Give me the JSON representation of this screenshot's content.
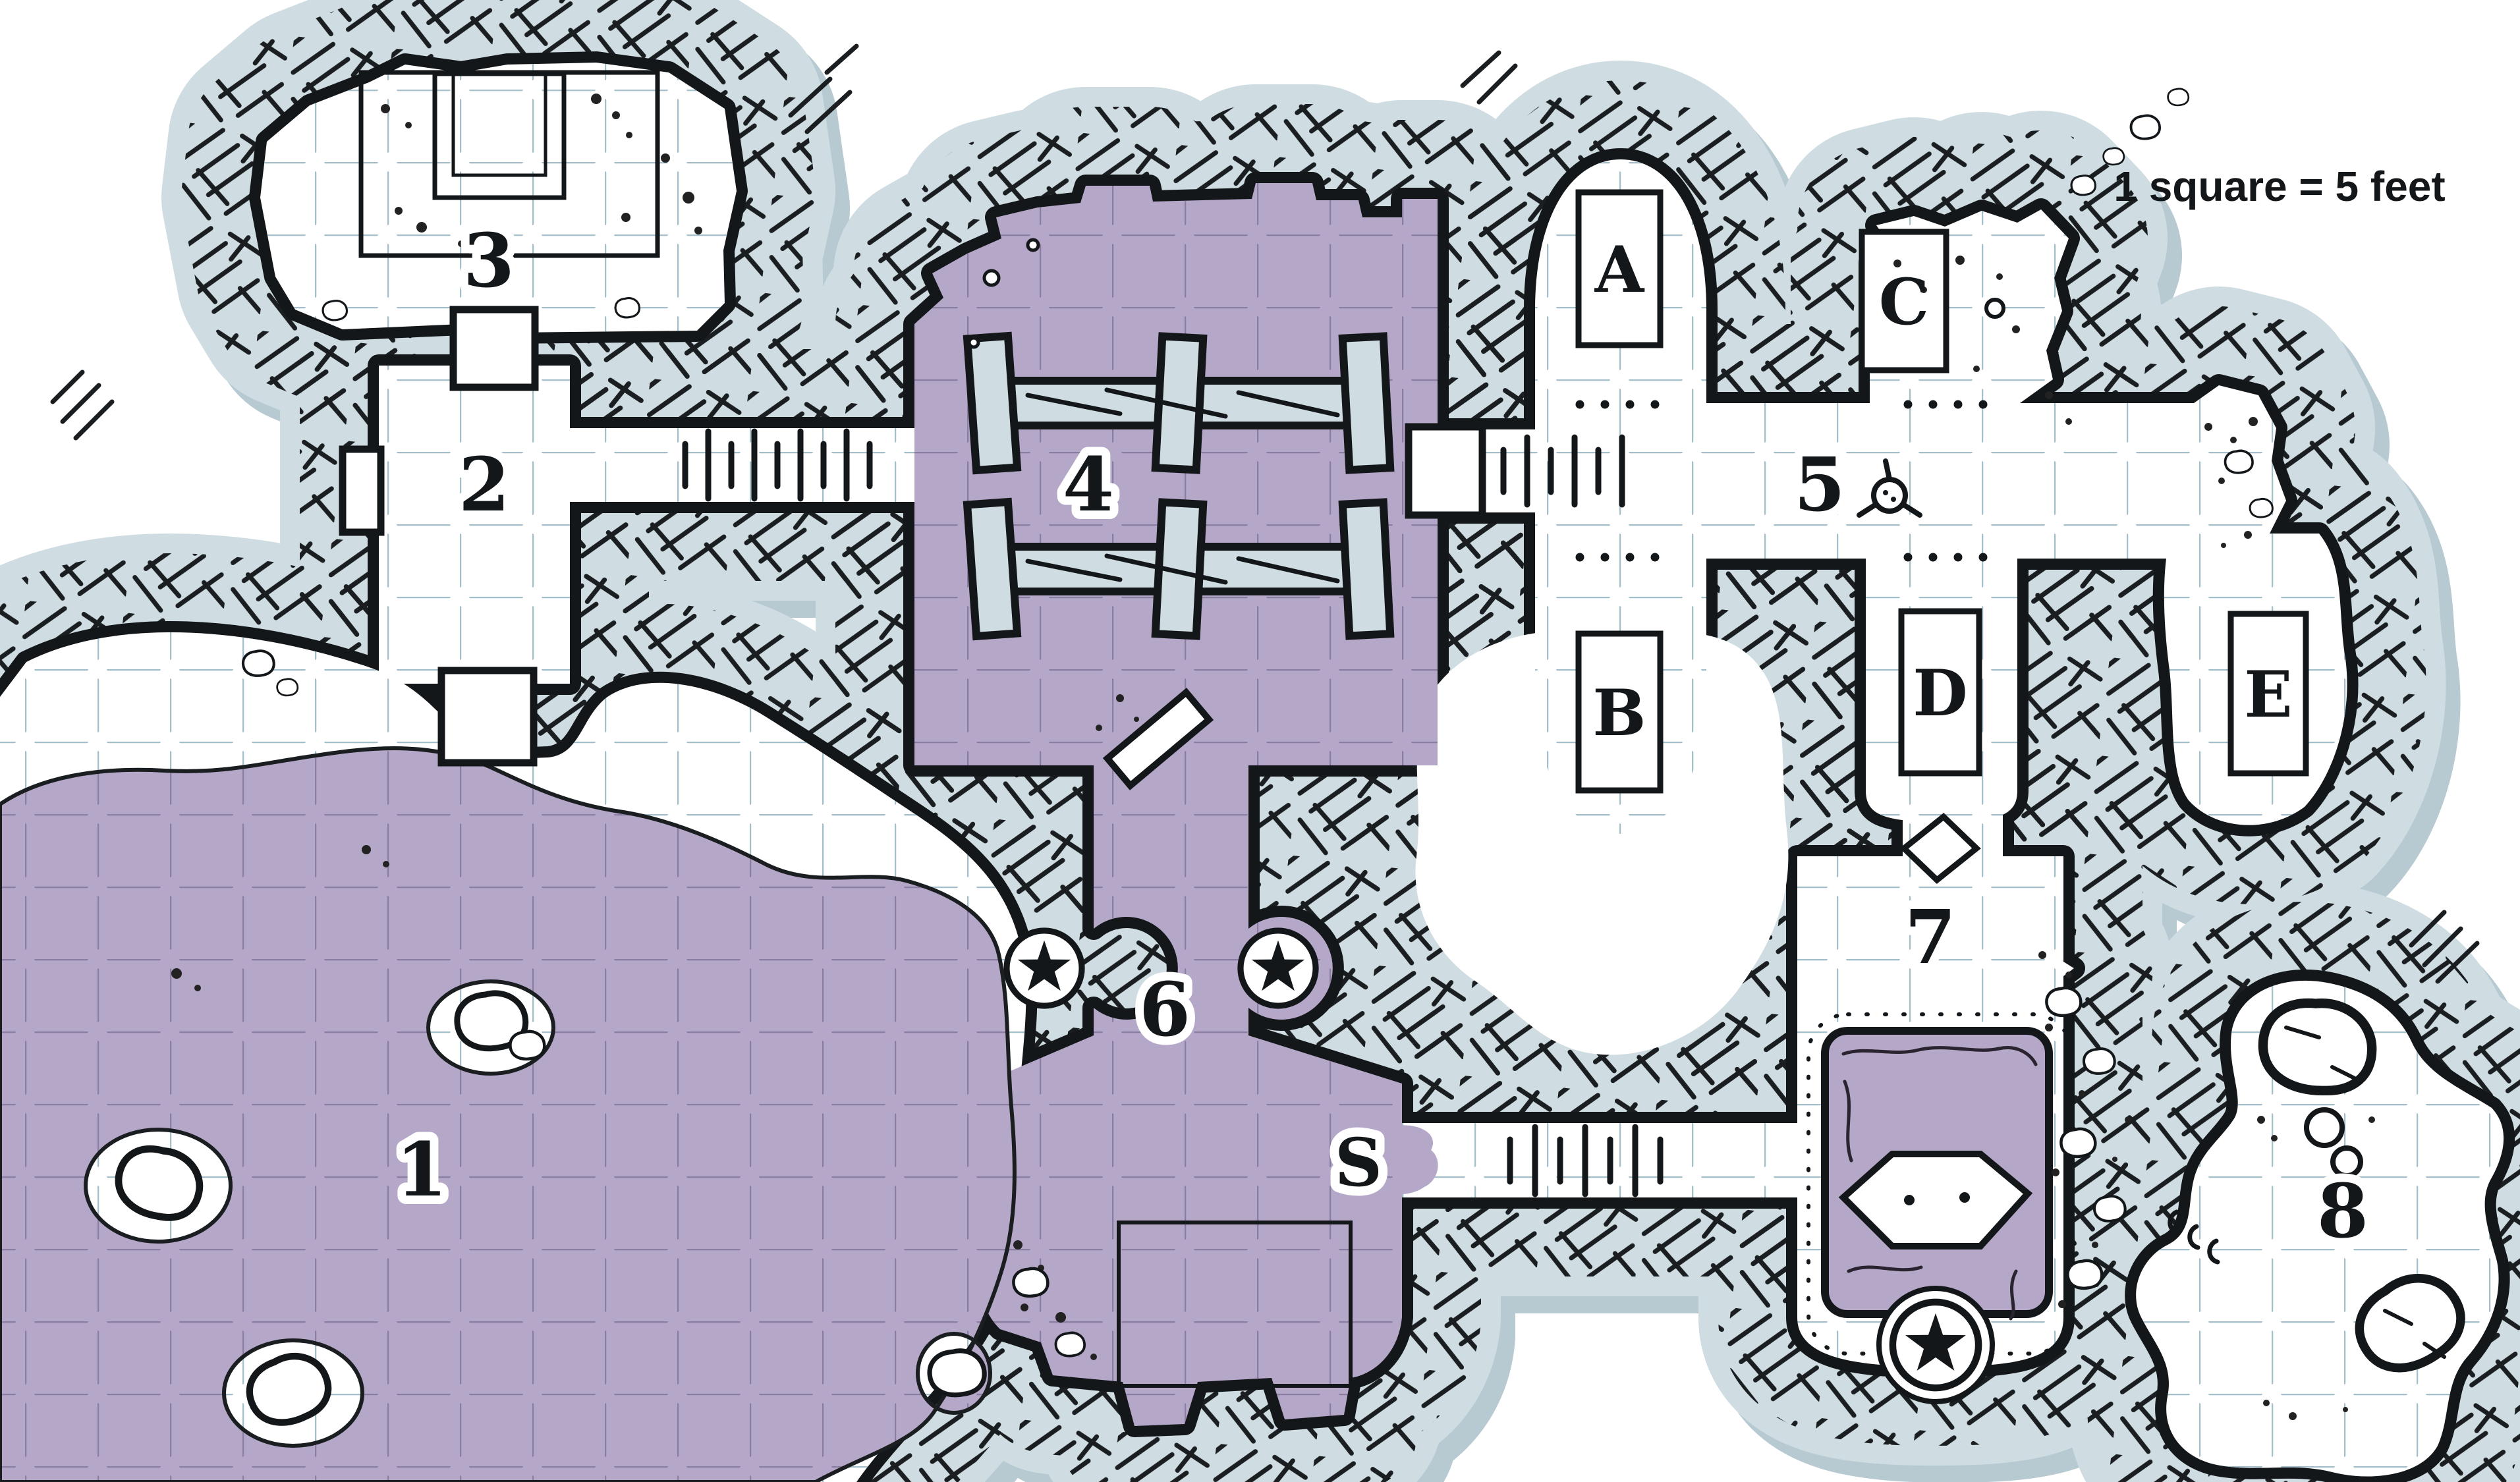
{
  "legend": {
    "scale_text": "1 square = 5 feet"
  },
  "map": {
    "rooms": [
      "1",
      "2",
      "3",
      "4",
      "5",
      "6",
      "7",
      "8"
    ],
    "alcoves": [
      "A",
      "B",
      "C",
      "D",
      "E"
    ],
    "markers": {
      "secret_passage": "S"
    }
  },
  "colors": {
    "background": "#ffffff",
    "floor_purple": "#b5a7c7",
    "grid_blue": "#a4bfc9",
    "grid_purple": "#8b7ea3",
    "rock_halo": "#cfdde2",
    "rock_shadow": "#b7cad2",
    "wall_ink": "#14171a"
  }
}
